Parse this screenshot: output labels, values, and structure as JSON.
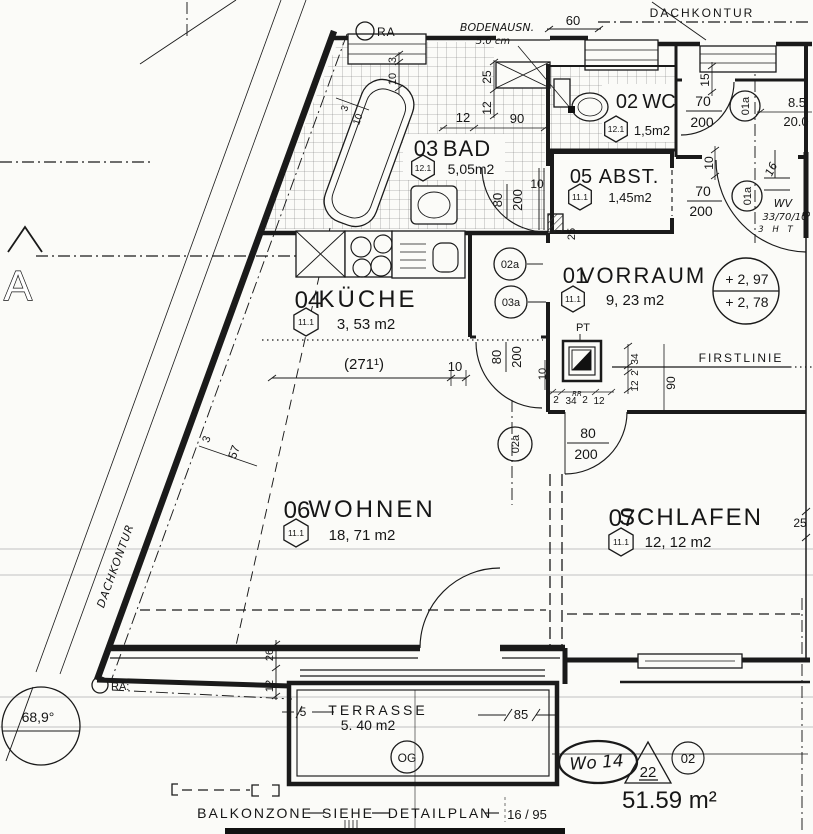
{
  "colors": {
    "ink": "#1a1a1a",
    "paper": "#fbfbf8",
    "scan_line": "#c8c8c8"
  },
  "rooms": {
    "vorraum": {
      "number": "01",
      "name": "VORRAUM",
      "tag": "11.1",
      "area": "9, 23 m2"
    },
    "wc": {
      "number": "02",
      "name": "WC",
      "tag": "12.1",
      "area": "1,5m2"
    },
    "bad": {
      "number": "03",
      "name": "BAD",
      "tag": "12.1",
      "area": "5,05m2"
    },
    "kueche": {
      "number": "04",
      "name": "KÜCHE",
      "tag": "11.1",
      "area": "3, 53 m2"
    },
    "abst": {
      "number": "05",
      "name": "ABST.",
      "tag": "11.1",
      "area": "1,45m2"
    },
    "wohnen": {
      "number": "06",
      "name": "WOHNEN",
      "tag": "11.1",
      "area": "18, 71 m2"
    },
    "schlafen": {
      "number": "07",
      "name": "SCHLAFEN",
      "tag": "11.1",
      "area": "12, 12 m2"
    },
    "terrasse": {
      "name": "TERRASSE",
      "area": "5. 40 m2"
    }
  },
  "doors": {
    "entry": {
      "tag": "01a",
      "w": "70",
      "h": "200"
    },
    "vorraum_north": {
      "tag": "01a",
      "w": "70",
      "h": "200"
    },
    "bad": {
      "tag": "02a",
      "w": "80",
      "h": "200"
    },
    "corridor": {
      "tag": "03a",
      "w": "80",
      "h": "200"
    },
    "schlafen": {
      "tag": "02a",
      "w": "80",
      "h": "200"
    }
  },
  "dimensions": {
    "top_60": "60",
    "box_25": "25",
    "box_12": "12",
    "bad_12": "12",
    "bad_90": "90",
    "bad_3": "3",
    "bad_10": "10",
    "diag_small_3": "3",
    "diag_small_10": "10",
    "wall_3": "3",
    "wall_57": "57",
    "wc_15": "15",
    "entry_85": "8.5",
    "entry_200": "20.0",
    "abst_10": "10",
    "right_3": "3",
    "baddoor_10": "10",
    "column_25": "25",
    "shaft_v_34": "34",
    "shaft_v_2": "2",
    "shaft_v_12": "12",
    "shaft_h_2a": "2",
    "shaft_h_34": "34",
    "shaft_h_2b": "2",
    "shaft_h_12": "12",
    "shaft_90": "90",
    "shaft_10": "10",
    "kueche_271": "(271¹)",
    "kueche_10": "10",
    "schlafen_25": "25",
    "terr_5": "5",
    "terr_85": "85",
    "left_26": "26",
    "left_12": "12"
  },
  "drawing": {
    "section_marker": "A",
    "angle": "68,9°",
    "dachkontur": "DACHKONTUR",
    "firstlinie": "FIRSTLINIE",
    "bodenausn_1": "BODENAUSN.",
    "bodenausn_2": "5.0 cm",
    "ra_top": "RA",
    "ra_bottom": "RA:",
    "pt": "PT",
    "rr": "RR",
    "wv_1": "WV",
    "wv_2": "33/70/10",
    "wv_3": "3 H T",
    "hand_16": "16",
    "level_upper": "+ 2, 97",
    "level_lower": "+ 2, 78",
    "og": "OG"
  },
  "title": {
    "unit": "Wo 14",
    "triangle": "22",
    "circle": "02",
    "total_area": "51.59 m²",
    "note_balkon": "BALKONZONE",
    "note_siehe": "SIEHE",
    "note_detail": "DETAILPLAN",
    "note_ref": "16 / 95"
  }
}
